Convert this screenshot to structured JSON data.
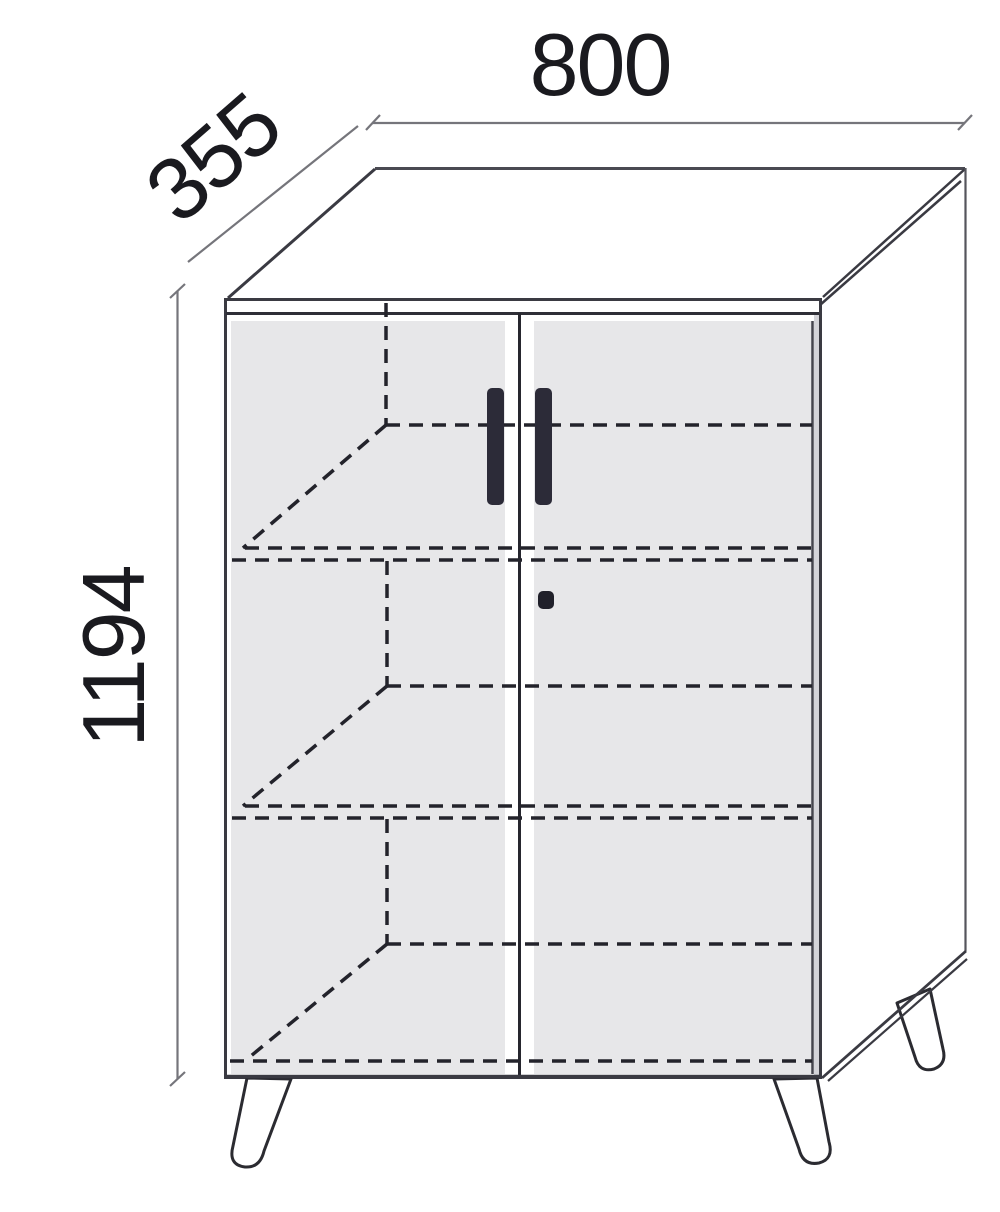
{
  "diagram": {
    "type": "furniture-dimension-drawing",
    "subject": "two-door cabinet with splayed hairpin legs, dashed hidden shelves, perspective view",
    "dimensions": {
      "width_label": "800",
      "depth_label": "355",
      "height_label": "1194"
    },
    "features": {
      "doors": 2,
      "handles": 2,
      "shelves_dashed": 3,
      "legs_visible": 3,
      "lock": "keyhole on right door"
    },
    "colors": {
      "background": "#ffffff",
      "outline": "#3a3a42",
      "hidden_line": "#23232b",
      "door_fill": "#e7e7e9",
      "handle_fill": "#2c2b38",
      "dimension_line": "#75757b",
      "label_text": "#1a1a1f"
    }
  }
}
